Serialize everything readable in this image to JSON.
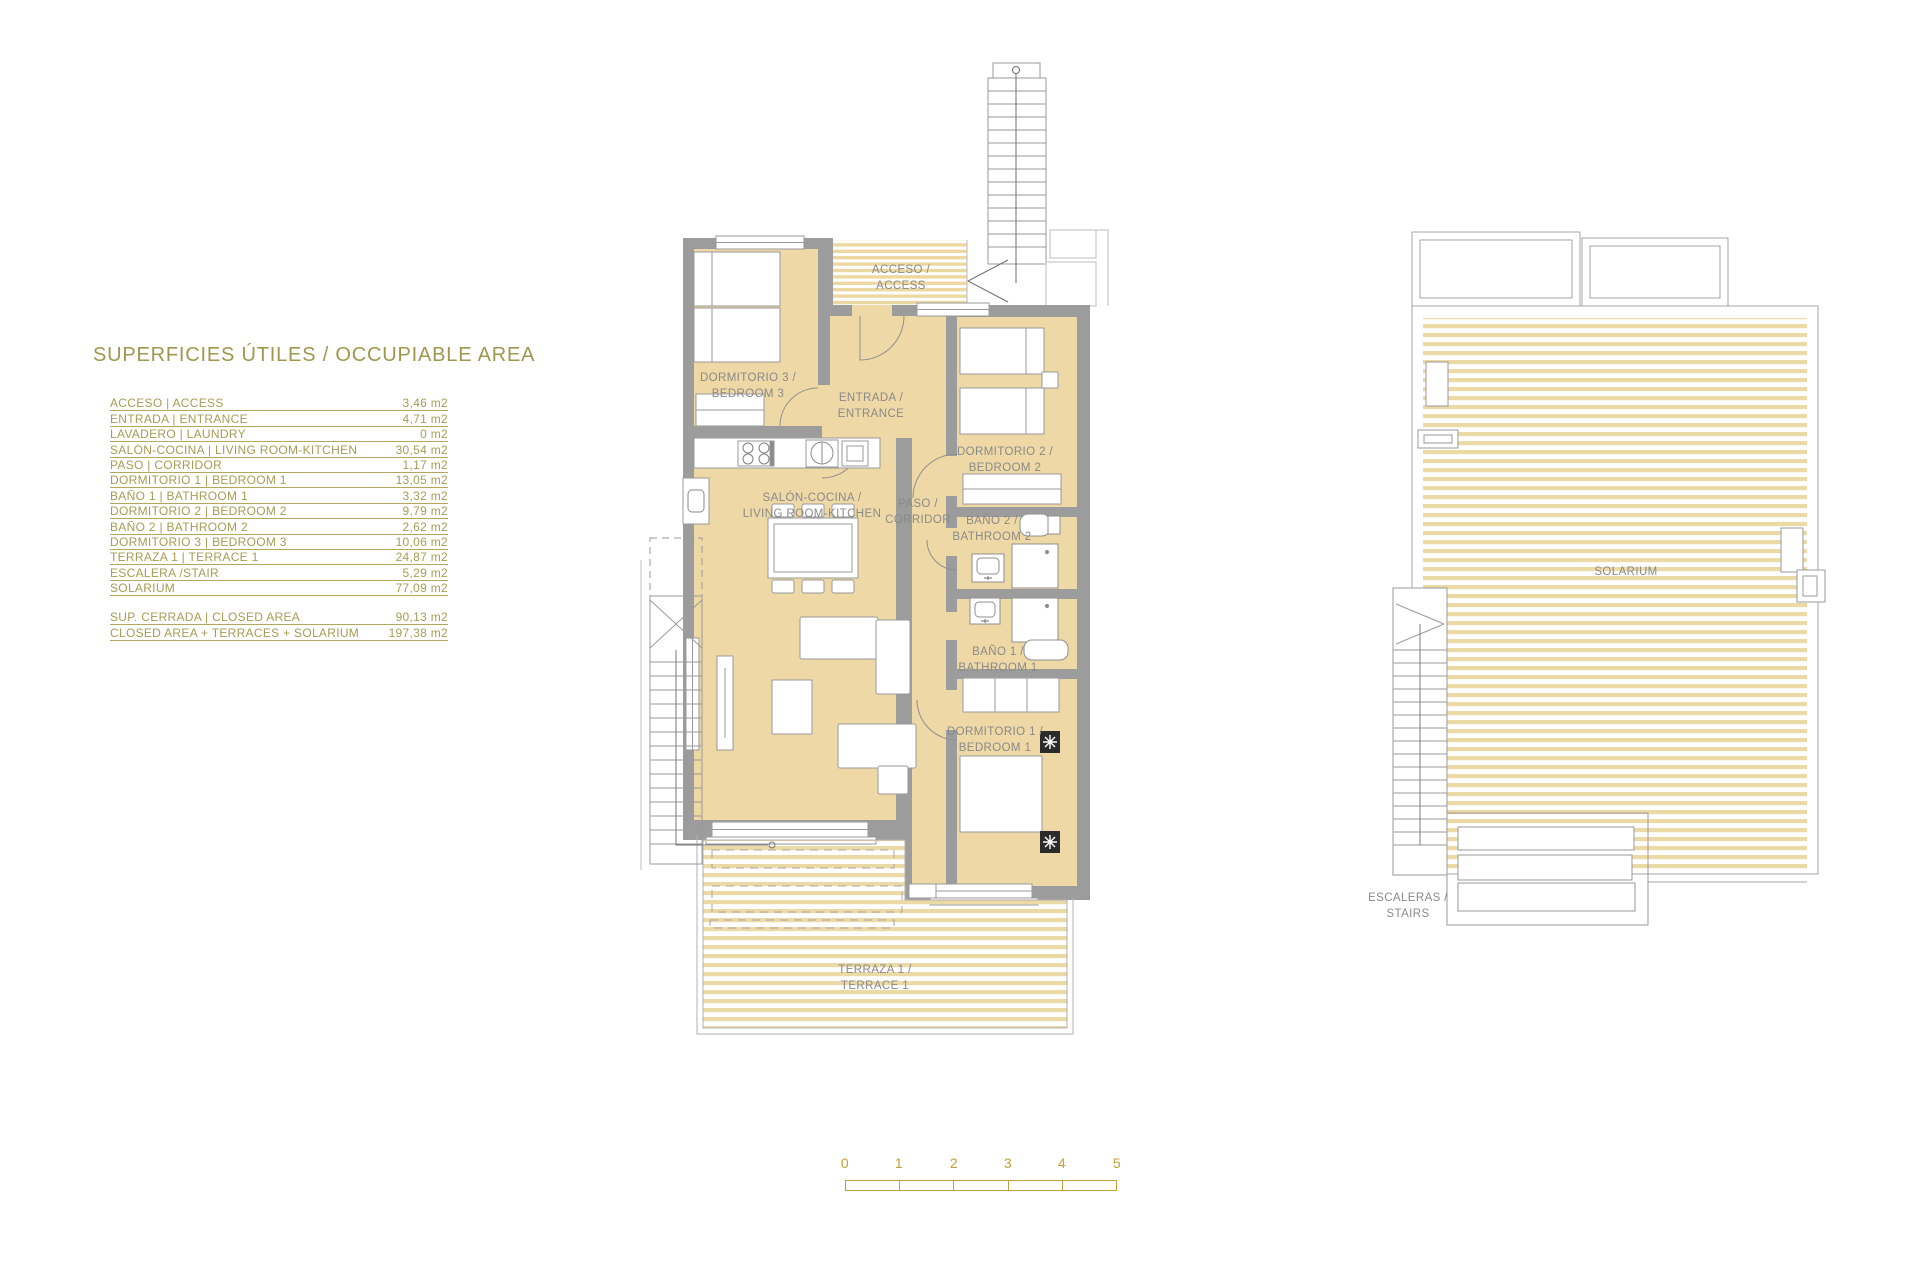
{
  "area_table": {
    "title": "SUPERFICIES ÚTILES / OCCUPIABLE AREA",
    "rows": [
      {
        "label": "ACCESO | ACCESS",
        "value": "3,46 m2"
      },
      {
        "label": "ENTRADA | ENTRANCE",
        "value": "4,71 m2"
      },
      {
        "label": "LAVADERO | LAUNDRY",
        "value": "0 m2"
      },
      {
        "label": "SALÓN-COCINA | LIVING ROOM-KITCHEN",
        "value": "30,54 m2"
      },
      {
        "label": "PASO | CORRIDOR",
        "value": "1,17 m2"
      },
      {
        "label": "DORMITORIO 1 | BEDROOM 1",
        "value": "13,05 m2"
      },
      {
        "label": "BAÑO 1 | BATHROOM 1",
        "value": "3,32 m2"
      },
      {
        "label": "DORMITORIO 2 | BEDROOM 2",
        "value": "9,79 m2"
      },
      {
        "label": "BAÑO 2 | BATHROOM 2",
        "value": "2,62 m2"
      },
      {
        "label": "DORMITORIO 3 | BEDROOM 3",
        "value": "10,06 m2"
      },
      {
        "label": "TERRAZA 1 | TERRACE 1",
        "value": "24,87 m2"
      },
      {
        "label": "ESCALERA /STAIR",
        "value": "5,29 m2"
      },
      {
        "label": "SOLARIUM",
        "value": "77,09 m2"
      }
    ],
    "summary_rows": [
      {
        "label": "SUP. CERRADA | CLOSED AREA",
        "value": "90,13 m2"
      },
      {
        "label": "CLOSED AREA + TERRACES + SOLARIUM",
        "value": "197,38 m2"
      }
    ]
  },
  "main_plan": {
    "acceso": {
      "line1": "ACCESO /",
      "line2": "ACCESS"
    },
    "dormitorio3": {
      "line1": "DORMITORIO 3 /",
      "line2": "BEDROOM 3"
    },
    "entrada": {
      "line1": "ENTRADA /",
      "line2": "ENTRANCE"
    },
    "dormitorio2": {
      "line1": "DORMITORIO 2 /",
      "line2": "BEDROOM 2"
    },
    "salon": {
      "line1": "SALÓN-COCINA /",
      "line2": "LIVING ROOM-KITCHEN"
    },
    "paso": {
      "line1": "PASO /",
      "line2": "CORRIDOR"
    },
    "bano2": {
      "line1": "BAÑO 2 /",
      "line2": "BATHROOM 2"
    },
    "bano1": {
      "line1": "BAÑO 1 /",
      "line2": "BATHROOM 1"
    },
    "dormitorio1": {
      "line1": "DORMITORIO 1 /",
      "line2": "BEDROOM 1"
    },
    "terraza": {
      "line1": "TERRAZA 1 /",
      "line2": "TERRACE 1"
    }
  },
  "solarium_plan": {
    "solarium_label": "SOLARIUM",
    "escaleras": {
      "line1": "ESCALERAS /",
      "line2": "STAIRS"
    }
  },
  "scale_bar": {
    "ticks": [
      "0",
      "1",
      "2",
      "3",
      "4",
      "5"
    ]
  },
  "colors": {
    "room_fill": "#EED8A5",
    "wall_gray": "#9C9C9C",
    "deck_stripe": "#EBD9A6",
    "table_text": "#A69C54",
    "plan_text": "#8A8A8A",
    "scale_gold": "#C3A037"
  }
}
